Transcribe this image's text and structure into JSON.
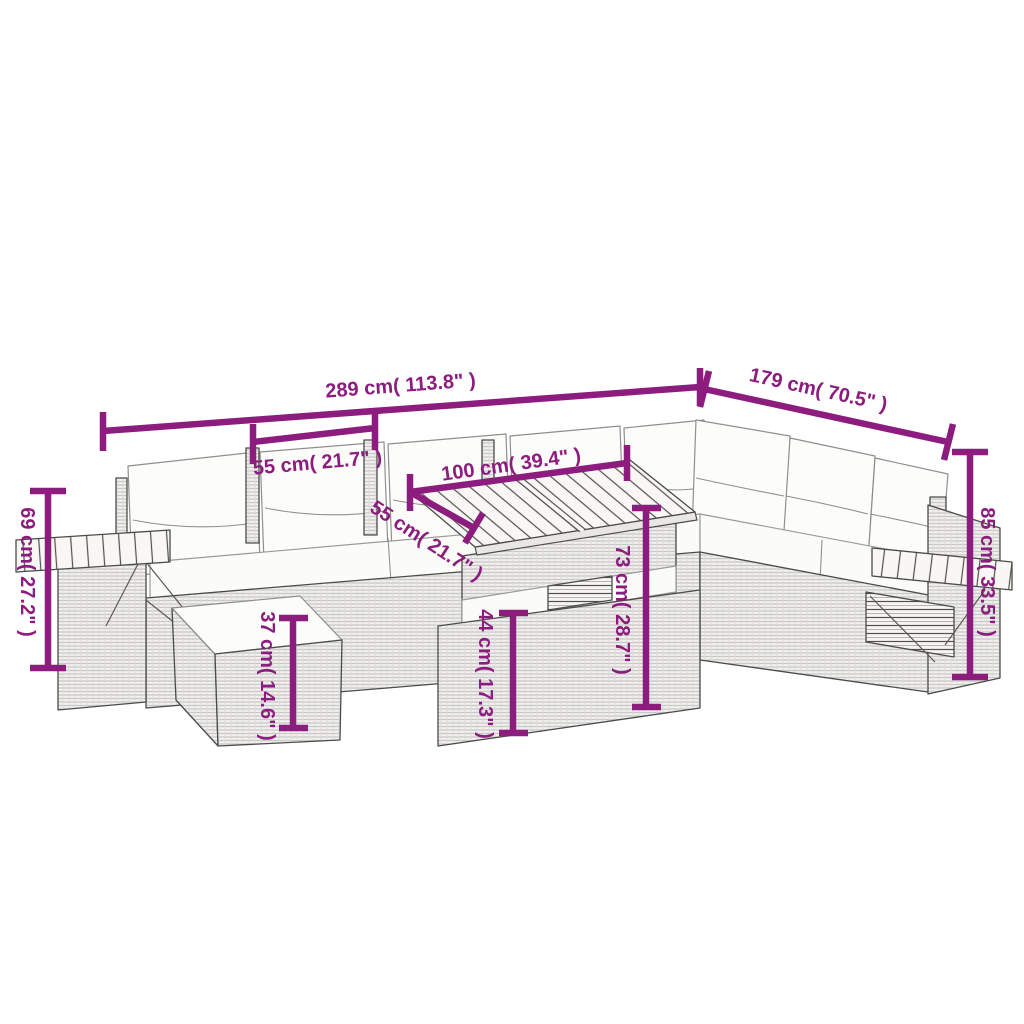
{
  "diagram": {
    "subject": "outdoor poly-rattan corner sofa set with ottoman and slatted-top table",
    "accent_color": "#8c1c7e",
    "background_color": "#ffffff",
    "dimensions": [
      {
        "id": "total-width",
        "label": "289 cm( 113.8\" )"
      },
      {
        "id": "right-side-depth",
        "label": "179 cm( 70.5\" )"
      },
      {
        "id": "seat-width",
        "label": "55 cm( 21.7\" )"
      },
      {
        "id": "table-length",
        "label": "100 cm( 39.4\" )"
      },
      {
        "id": "table-width",
        "label": "55 cm( 21.7\" )"
      },
      {
        "id": "table-height",
        "label": "73 cm( 28.7\" )"
      },
      {
        "id": "ottoman-height",
        "label": "37 cm( 14.6\" )"
      },
      {
        "id": "armrest-height",
        "label": "69 cm( 27.2\" )"
      },
      {
        "id": "back-height",
        "label": "85 cm( 33.5\" )"
      },
      {
        "id": "table-base-height",
        "label": "44 cm( 17.3\" )"
      }
    ]
  }
}
